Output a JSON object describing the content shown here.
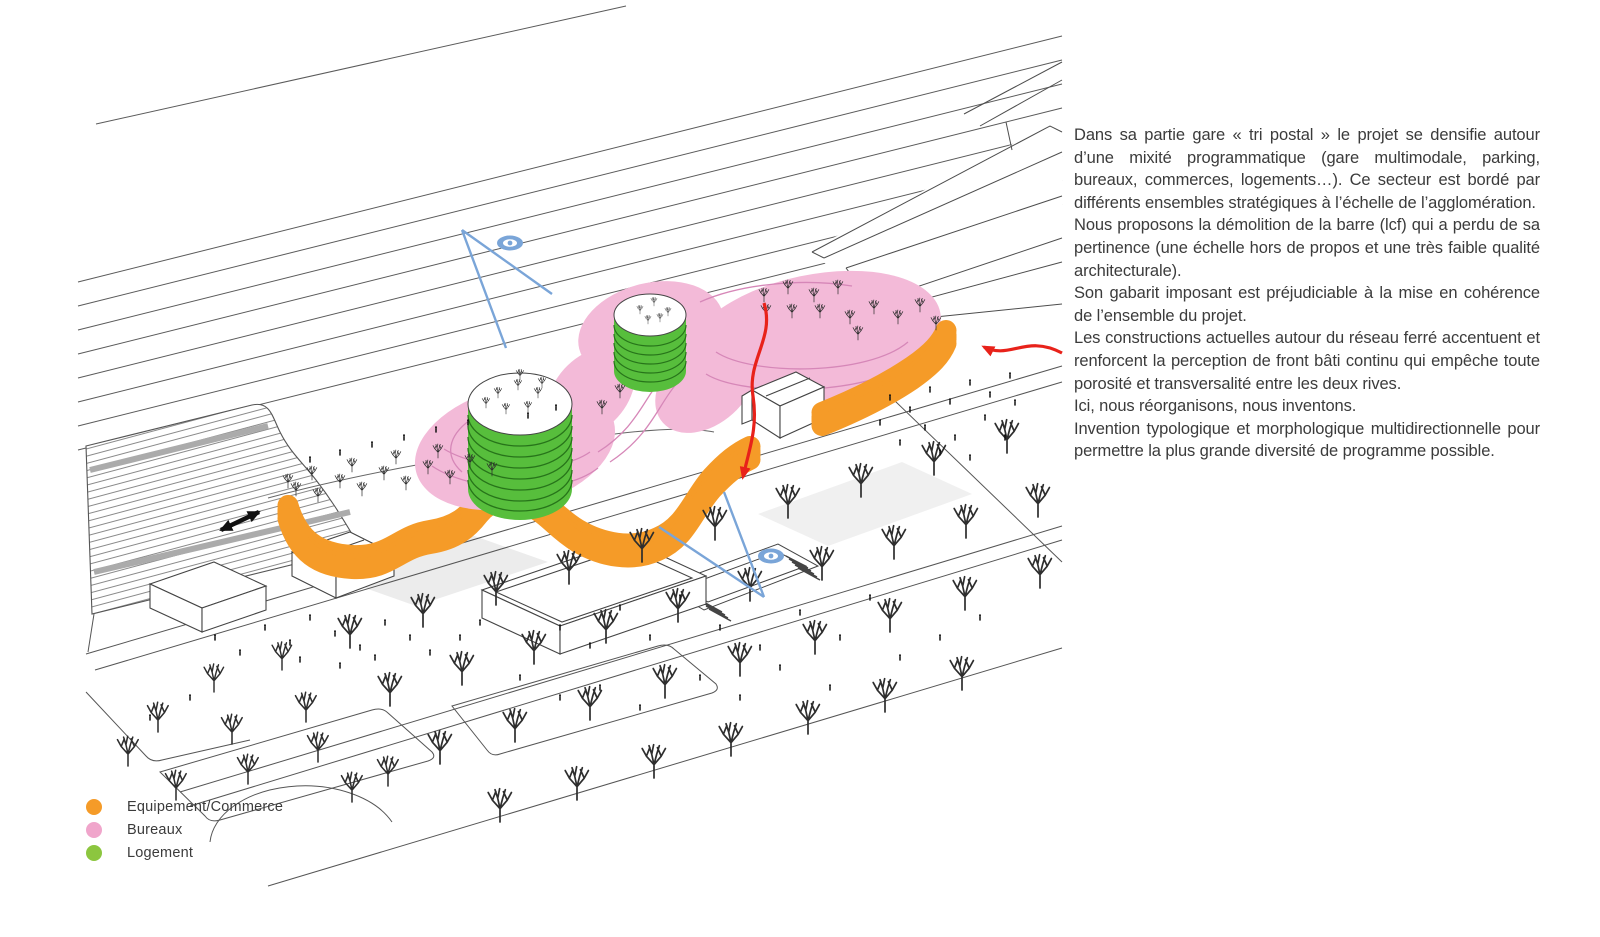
{
  "palette": {
    "orange": "#F59B28",
    "orange_stripe": "#AE6F0E",
    "pink": "#F3BAD8",
    "pink_stripe": "#D687B8",
    "green": "#57BE3C",
    "green_stripe": "#27741A",
    "blue": "#7AA5D8",
    "red": "#E8221A",
    "ink": "#3B3B3B",
    "line": "#4D4D4D",
    "plaza_gray": "#ECECEC"
  },
  "figure": {
    "type": "axonometric-site-diagram",
    "icons": [
      "eye-view-icon",
      "view-cone-lines",
      "red-direction-arrow",
      "pedestrian-link-double-arrow"
    ]
  },
  "legend": {
    "items": [
      {
        "label": "Equipement/Commerce",
        "color": "#F59B28"
      },
      {
        "label": "Bureaux",
        "color": "#F0A5CB"
      },
      {
        "label": "Logement",
        "color": "#8CC63F"
      }
    ]
  },
  "article": {
    "paragraphs": [
      "Dans sa partie gare « tri postal » le projet se densifie autour d’une mixité programmatique (gare multimodale, parking, bureaux, commerces, logements…). Ce secteur est bordé par différents ensembles stratégiques à l’échelle de l’agglomération.",
      "Nous proposons la démolition de la barre (lcf) qui a perdu de sa pertinence (une échelle hors de propos et une très faible qualité architecturale).",
      "Son gabarit imposant est préjudiciable à la mise en cohérence de l’ensemble du projet.",
      "Les constructions actuelles autour du réseau ferré accentuent et renforcent la perception de front bâti continu qui empêche toute porosité et transversalité entre les deux rives.",
      "Ici, nous réorganisons, nous inventons.",
      "Invention typologique et morphologique multidirectionnelle pour permettre la plus grande diversité de programme possible."
    ]
  }
}
